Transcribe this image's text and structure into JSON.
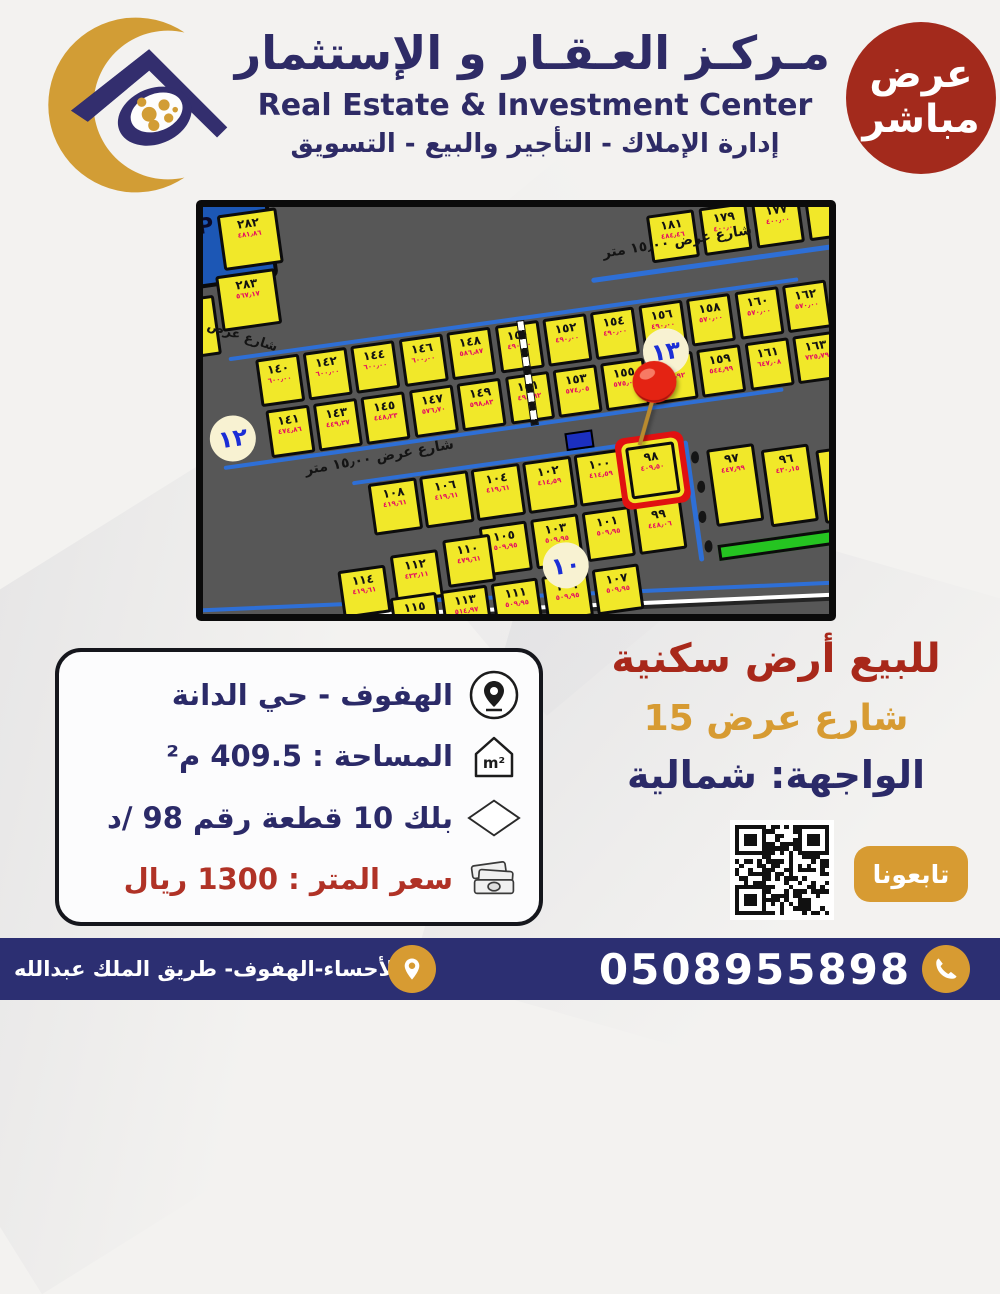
{
  "header": {
    "title_ar": "مـركـز العـقـار و الإستثمار",
    "title_en": "Real Estate & Investment Center",
    "subtitle_ar": "إدارة الإملاك - التأجير والبيع - التسويق",
    "badge_line1": "عرض",
    "badge_line2": "مباشر"
  },
  "map": {
    "street_label": "شارع عرض ١٥٫٠٠ متر",
    "street_label_short": "شارع عرض",
    "parking_label": "P",
    "block_circles": {
      "left": "١٢",
      "right": "١٣",
      "bottom": "١٠"
    },
    "highlight_plot": "٩٨",
    "top_row_plots": [
      {
        "n": "١٨١",
        "a": "٤٨٤٫٤٦"
      },
      {
        "n": "١٧٩",
        "a": "٤٠٠٫٠٠"
      },
      {
        "n": "١٧٧",
        "a": "٤٠٠٫٠٠"
      }
    ],
    "left_column_plots": [
      {
        "n": "٢٨٢",
        "a": "٤٨١٫٨٦"
      },
      {
        "n": "٢٨٣",
        "a": "٥٦٧٫١٧"
      },
      {
        "n": "٢٨٥",
        "a": "٧٦٧٫٢٩"
      }
    ],
    "row_upper": [
      {
        "n": "١٦٢",
        "a": "٥٧٠٫٠٠"
      },
      {
        "n": "١٦٠",
        "a": "٥٧٠٫٠٠"
      },
      {
        "n": "١٥٨",
        "a": "٥٧٠٫٠٠"
      },
      {
        "n": "١٥٦",
        "a": "٤٩٠٫٠٠"
      },
      {
        "n": "١٥٤",
        "a": "٤٩٠٫٠٠"
      },
      {
        "n": "١٥٢",
        "a": "٤٩٠٫٠٠"
      },
      {
        "n": "١٥٠",
        "a": "٤٩٠٫٠٠"
      },
      {
        "n": "١٤٨",
        "a": "٥٨٦٫٨٧"
      },
      {
        "n": "١٤٦",
        "a": "٦٠٠٫٠٠"
      },
      {
        "n": "١٤٤",
        "a": "٦٠٠٫٠٠"
      },
      {
        "n": "١٤٢",
        "a": "٦٠٠٫٠٠"
      },
      {
        "n": "١٤٠",
        "a": "٦٠٠٫٠٠"
      }
    ],
    "row_lower": [
      {
        "n": "١٦٣",
        "a": "٧٢٥٫٧٩"
      },
      {
        "n": "١٦١",
        "a": "٦٤٧٫٠٨"
      },
      {
        "n": "١٥٩",
        "a": "٥٤٤٫٩٩"
      },
      {
        "n": "١٥٧",
        "a": "٥٧٦٫٩٢"
      },
      {
        "n": "١٥٥",
        "a": "٥٧٥٫٠٠"
      },
      {
        "n": "١٥٣",
        "a": "٥٧٤٫٠٥"
      },
      {
        "n": "١٥١",
        "a": "٤٩٨٫٩٢"
      },
      {
        "n": "١٤٩",
        "a": "٥٩٨٫٨٣"
      },
      {
        "n": "١٤٧",
        "a": "٥٧٦٫٧٠"
      },
      {
        "n": "١٤٥",
        "a": "٤٤٨٫٢٣"
      },
      {
        "n": "١٤٣",
        "a": "٤٤٩٫٣٧"
      },
      {
        "n": "١٤١",
        "a": "٤٧٤٫٨٦"
      }
    ],
    "row_b10_top": [
      {
        "n": "٩٨",
        "a": "٤٠٩٫٥٠"
      },
      {
        "n": "١٠٠",
        "a": "٤١٤٫٥٩"
      },
      {
        "n": "١٠٢",
        "a": "٤١٤٫٥٩"
      },
      {
        "n": "١٠٤",
        "a": "٤١٩٫٦١"
      },
      {
        "n": "١٠٦",
        "a": "٤١٩٫٦١"
      },
      {
        "n": "١٠٨",
        "a": "٤١٩٫٦١"
      }
    ],
    "row_b10_mid4": [
      {
        "n": "٩٩",
        "a": "٤٤٨٫٠٦"
      },
      {
        "n": "١٠١",
        "a": "٥٠٩٫٩٥"
      },
      {
        "n": "١٠٣",
        "a": "٥٠٩٫٩٥"
      },
      {
        "n": "١٠٥",
        "a": "٥٠٩٫٩٥"
      }
    ],
    "row_b10_left": [
      {
        "n": "١١٠",
        "a": "٤٧٩٫٦١"
      },
      {
        "n": "١١٢",
        "a": "٤٣٣٫١١"
      },
      {
        "n": "١١٤",
        "a": "٤١٩٫٦١"
      }
    ],
    "row_b10_bottom": [
      {
        "n": "١٠٧",
        "a": "٥٠٩٫٩٥"
      },
      {
        "n": "١٠٩",
        "a": "٥٠٩٫٩٥"
      },
      {
        "n": "١١١",
        "a": "٥٠٩٫٩٥"
      },
      {
        "n": "١١٣",
        "a": "٥١٤٫٩٧"
      },
      {
        "n": "١١٥",
        "a": "٥٠١٫٨٨"
      }
    ],
    "right_plots": [
      {
        "n": "٩٧",
        "a": "٤٤٧٫٩٩"
      },
      {
        "n": "٩٦",
        "a": "٤٣٠٫١٥"
      }
    ]
  },
  "details_card": {
    "location": "الهفوف - حي الدانة",
    "area": "المساحة : 409.5 م²",
    "block": "بلك 10  قطعة رقم 98 /د",
    "price": "سعر المتر :  1300 ريال"
  },
  "offer": {
    "line1": "للبيع أرض سكنية",
    "line2": "شارع عرض 15",
    "line3": "الواجهة: شمالية"
  },
  "follow": {
    "label": "تابعونا"
  },
  "footer": {
    "address": "الأحساء-الهفوف- طريق الملك عبدالله",
    "phone": "0508955898"
  },
  "watermark": {
    "text_ar": "عقار",
    "text_en": "sa.aqar"
  },
  "colors": {
    "badge_red": "#a32a1c",
    "offer_red": "#a8281a",
    "gold": "#d79b32",
    "navy": "#2d2a6a",
    "footer_navy": "#2c2f72",
    "map_yellow": "#f1e829",
    "highlight_red": "#e01111",
    "parcel_blue": "#1c57b5",
    "green_strip": "#25c421",
    "plot_area_red": "#e51060"
  }
}
